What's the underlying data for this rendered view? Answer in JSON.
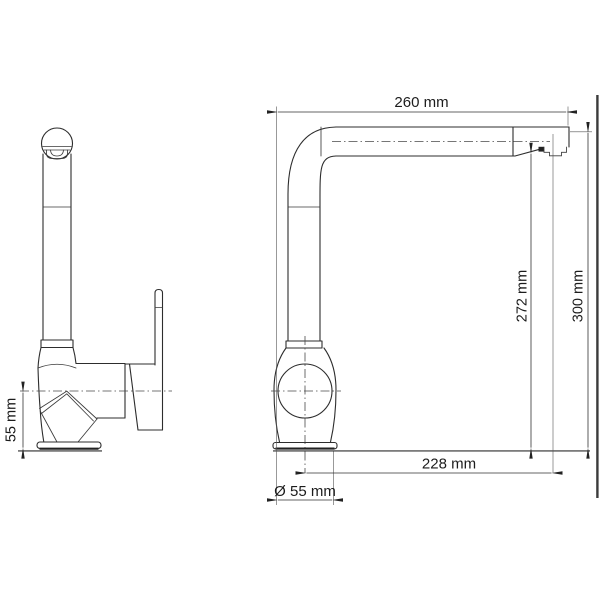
{
  "drawing": {
    "type": "technical-dimension-drawing",
    "subject": "kitchen mixer tap, front view and side view",
    "background_color": "#ffffff",
    "line_color": "#2d2d2d",
    "labels": {
      "spout_reach": "260 mm",
      "underspout_height": "272 mm",
      "total_height": "300 mm",
      "outlet_offset": "228 mm",
      "base_diameter": "Ø 55 mm",
      "body_center_height": "55 mm"
    }
  }
}
